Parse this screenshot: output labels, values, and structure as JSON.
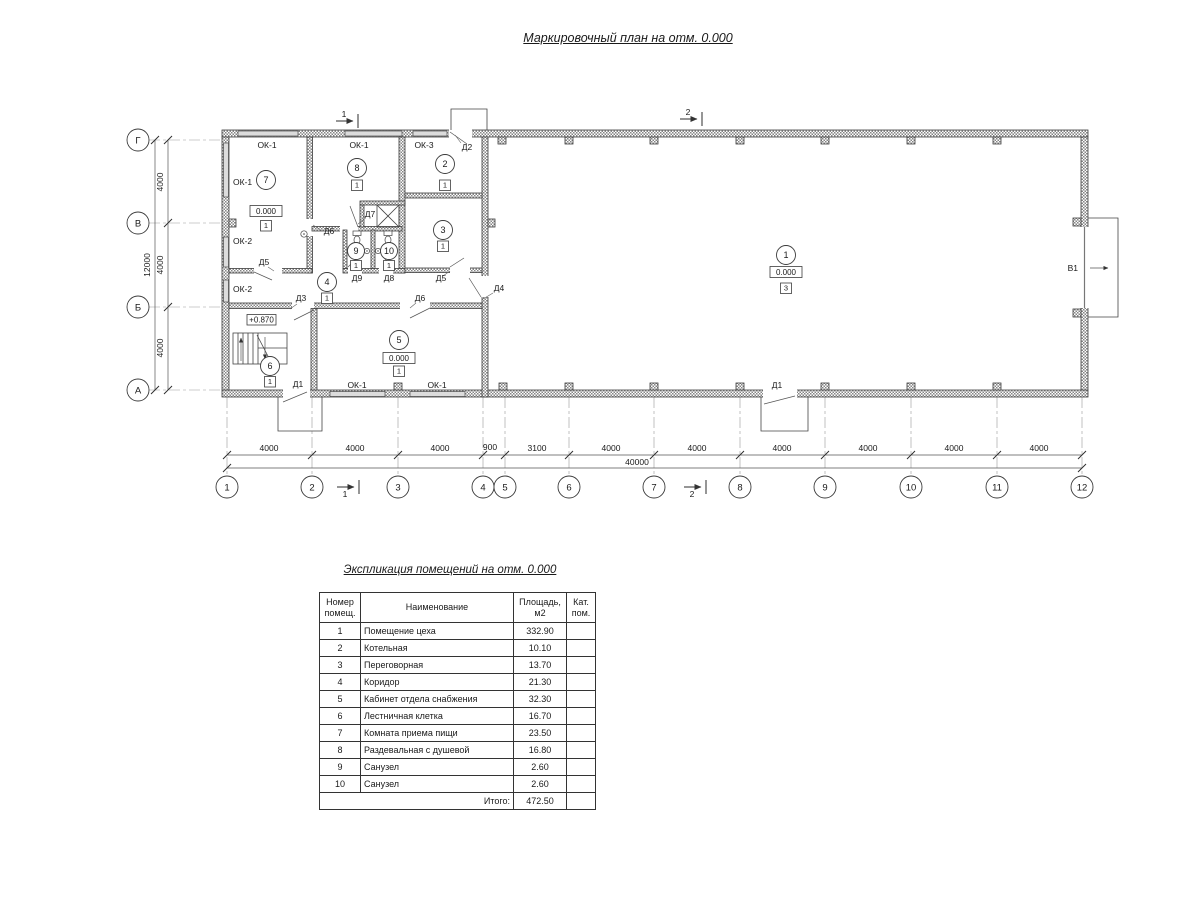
{
  "page": {
    "main_title": "Маркировочный план на отм. 0.000"
  },
  "plan": {
    "grid_cols": [
      "1",
      "2",
      "3",
      "4",
      "5",
      "6",
      "7",
      "8",
      "9",
      "10",
      "11",
      "12"
    ],
    "grid_rows": [
      "Г",
      "В",
      "Б",
      "А"
    ],
    "dims_bottom": [
      "4000",
      "4000",
      "4000",
      "900",
      "3100",
      "4000",
      "4000",
      "4000",
      "4000",
      "4000",
      "4000"
    ],
    "dim_total_bottom": "40000",
    "dims_left": [
      "4000",
      "4000",
      "4000"
    ],
    "dim_total_left": "12000",
    "section_marks": {
      "s1": "1",
      "s2": "2"
    },
    "gate_label": "В1",
    "stair_elev": "+0.870",
    "window_labels": [
      "ОК-1",
      "ОК-1",
      "ОК-3",
      "ОК-1",
      "ОК-2",
      "ОК-2",
      "ОК-1",
      "ОК-1"
    ],
    "door_labels": [
      "Д1",
      "Д1",
      "Д2",
      "Д3",
      "Д4",
      "Д5",
      "Д5",
      "Д6",
      "Д6",
      "Д7",
      "Д8",
      "Д9"
    ],
    "rooms": [
      {
        "num": "1",
        "elev": "0.000",
        "cat": "3"
      },
      {
        "num": "2",
        "cat": "1"
      },
      {
        "num": "3",
        "cat": "1"
      },
      {
        "num": "4",
        "cat": "1"
      },
      {
        "num": "5",
        "elev": "0.000",
        "cat": "1"
      },
      {
        "num": "6",
        "cat": "1"
      },
      {
        "num": "7",
        "elev": "0.000",
        "cat": "1"
      },
      {
        "num": "8",
        "cat": "1"
      },
      {
        "num": "9",
        "cat": "1"
      },
      {
        "num": "10",
        "cat": "1"
      }
    ]
  },
  "schedule": {
    "title": "Экспликация помещений на отм. 0.000",
    "headers": {
      "num1": "Номер",
      "num2": "помещ.",
      "name": "Наименование",
      "area1": "Площадь,",
      "area2": "м2",
      "cat1": "Кат.",
      "cat2": "пом."
    },
    "rows": [
      {
        "num": "1",
        "name": "Помещение цеха",
        "area": "332.90",
        "cat": ""
      },
      {
        "num": "2",
        "name": "Котельная",
        "area": "10.10",
        "cat": ""
      },
      {
        "num": "3",
        "name": "Переговорная",
        "area": "13.70",
        "cat": ""
      },
      {
        "num": "4",
        "name": "Коридор",
        "area": "21.30",
        "cat": ""
      },
      {
        "num": "5",
        "name": "Кабинет отдела снабжения",
        "area": "32.30",
        "cat": ""
      },
      {
        "num": "6",
        "name": "Лестничная клетка",
        "area": "16.70",
        "cat": ""
      },
      {
        "num": "7",
        "name": "Комната приема пищи",
        "area": "23.50",
        "cat": ""
      },
      {
        "num": "8",
        "name": "Раздевальная с душевой",
        "area": "16.80",
        "cat": ""
      },
      {
        "num": "9",
        "name": "Санузел",
        "area": "2.60",
        "cat": ""
      },
      {
        "num": "10",
        "name": "Санузел",
        "area": "2.60",
        "cat": ""
      }
    ],
    "total_label": "Итого:",
    "total_area": "472.50"
  }
}
